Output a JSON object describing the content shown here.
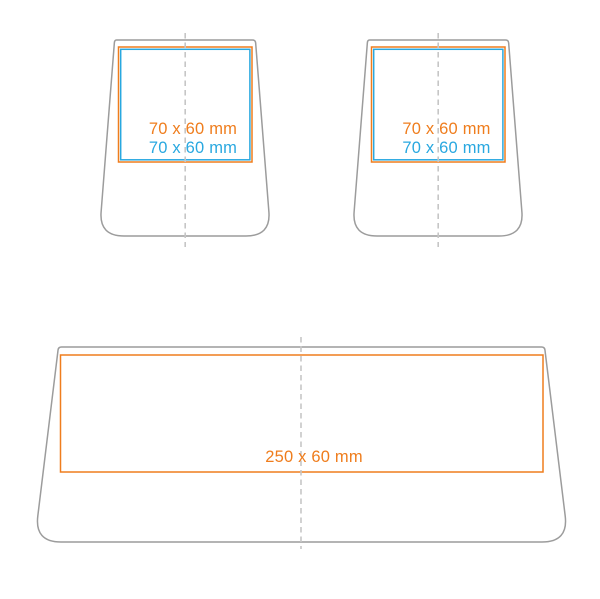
{
  "colors": {
    "background": "#ffffff",
    "outline": "#9c9c9c",
    "centerline": "#c6c6c6",
    "orange": "#ef7d1d",
    "blue": "#29a8e0"
  },
  "diagram": {
    "description": "Product print-area template: two tapered pot/holder front views and one wide tray front view with marked imprint zones",
    "pots": [
      {
        "name": "pot-left",
        "print_area_orange_label": "70 x 60 mm",
        "print_area_blue_label": "70 x 60 mm"
      },
      {
        "name": "pot-right",
        "print_area_orange_label": "70 x 60 mm",
        "print_area_blue_label": "70 x 60 mm"
      }
    ],
    "tray": {
      "name": "tray-bottom",
      "print_area_orange_label": "250 x 60 mm"
    }
  }
}
